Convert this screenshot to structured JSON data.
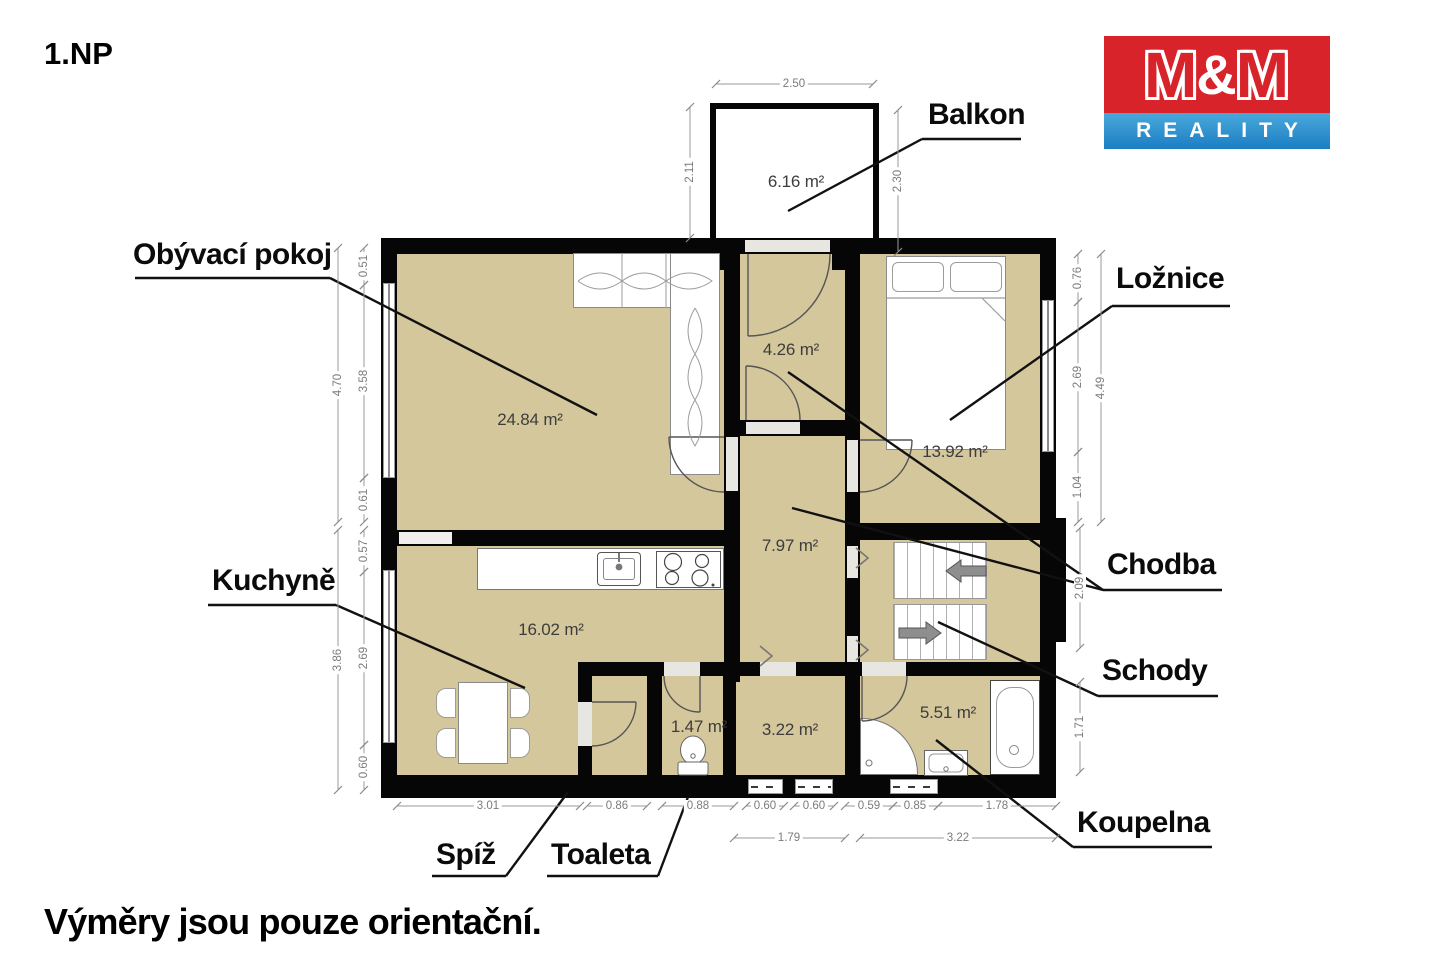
{
  "page": {
    "floor_label": "1.NP",
    "footer_note": "Výměry jsou pouze orientační."
  },
  "logo": {
    "m1": "M",
    "amp": "&",
    "m2": "M",
    "subtitle": "REALITY",
    "red": "#d8232a",
    "blue": "#2b8fce"
  },
  "colors": {
    "floor_fill": "#d5c79c",
    "wall": "#060606",
    "dimension": "#7b7b7b"
  },
  "room_labels": [
    {
      "id": "obyvaci-pokoj",
      "text": "Obývací pokoj",
      "x": 133,
      "y": 238,
      "underline": [
        135,
        278,
        330,
        278
      ],
      "leaders": [
        [
          330,
          278,
          597,
          415
        ]
      ]
    },
    {
      "id": "balkon",
      "text": "Balkon",
      "x": 928,
      "y": 98,
      "underline": [
        922,
        139,
        1021,
        139
      ],
      "leaders": [
        [
          922,
          139,
          788,
          211
        ]
      ]
    },
    {
      "id": "loznice",
      "text": "Ložnice",
      "x": 1116,
      "y": 262,
      "underline": [
        1112,
        306,
        1230,
        306
      ],
      "leaders": [
        [
          1112,
          306,
          950,
          420
        ]
      ]
    },
    {
      "id": "chodba",
      "text": "Chodba",
      "x": 1107,
      "y": 548,
      "underline": [
        1103,
        590,
        1222,
        590
      ],
      "leaders": [
        [
          1103,
          590,
          792,
          508
        ],
        [
          1103,
          590,
          788,
          372
        ]
      ]
    },
    {
      "id": "schody",
      "text": "Schody",
      "x": 1102,
      "y": 654,
      "underline": [
        1098,
        696,
        1218,
        696
      ],
      "leaders": [
        [
          1098,
          696,
          938,
          622
        ]
      ]
    },
    {
      "id": "kuchyne",
      "text": "Kuchyně",
      "x": 212,
      "y": 564,
      "underline": [
        208,
        605,
        336,
        605
      ],
      "leaders": [
        [
          336,
          605,
          525,
          688
        ]
      ]
    },
    {
      "id": "spiz",
      "text": "Spíž",
      "x": 436,
      "y": 838,
      "underline": [
        432,
        876,
        506,
        876
      ],
      "leaders": [
        [
          506,
          876,
          568,
          792
        ]
      ]
    },
    {
      "id": "toaleta",
      "text": "Toaleta",
      "x": 551,
      "y": 838,
      "underline": [
        547,
        876,
        658,
        876
      ],
      "leaders": [
        [
          658,
          876,
          688,
          797
        ]
      ]
    },
    {
      "id": "koupelna",
      "text": "Koupelna",
      "x": 1077,
      "y": 806,
      "underline": [
        1073,
        847,
        1212,
        847
      ],
      "leaders": [
        [
          1073,
          847,
          936,
          740
        ]
      ]
    }
  ],
  "area_labels": [
    {
      "id": "balkon",
      "text": "6.16 m²",
      "x": 796,
      "y": 182
    },
    {
      "id": "obyvaci-pokoj",
      "text": "24.84 m²",
      "x": 530,
      "y": 420
    },
    {
      "id": "loznice",
      "text": "13.92 m²",
      "x": 955,
      "y": 452
    },
    {
      "id": "vestibul",
      "text": "4.26 m²",
      "x": 791,
      "y": 350
    },
    {
      "id": "chodba",
      "text": "7.97 m²",
      "x": 790,
      "y": 546
    },
    {
      "id": "kuchyne",
      "text": "16.02 m²",
      "x": 551,
      "y": 630
    },
    {
      "id": "toaleta",
      "text": "1.47 m²",
      "x": 699,
      "y": 727
    },
    {
      "id": "predsin",
      "text": "3.22 m²",
      "x": 790,
      "y": 730
    },
    {
      "id": "koupelna",
      "text": "5.51 m²",
      "x": 948,
      "y": 713
    }
  ],
  "dimensions": [
    {
      "label": "2.50",
      "x": 794,
      "y": 84,
      "v": false,
      "line": [
        716,
        84,
        873,
        84
      ]
    },
    {
      "label": "2.11",
      "x": 690,
      "y": 172,
      "v": true,
      "line": [
        690,
        107,
        690,
        238
      ]
    },
    {
      "label": "2.30",
      "x": 898,
      "y": 181,
      "v": true,
      "line": [
        898,
        110,
        898,
        252
      ]
    },
    {
      "label": "4.70",
      "x": 338,
      "y": 385,
      "v": true,
      "line": [
        338,
        248,
        338,
        522
      ]
    },
    {
      "label": "0.51",
      "x": 364,
      "y": 266,
      "v": true,
      "line": [
        364,
        248,
        364,
        285
      ]
    },
    {
      "label": "3.58",
      "x": 364,
      "y": 381,
      "v": true,
      "line": [
        364,
        285,
        364,
        478
      ]
    },
    {
      "label": "0.61",
      "x": 364,
      "y": 500,
      "v": true,
      "line": [
        364,
        478,
        364,
        522
      ]
    },
    {
      "label": "3.86",
      "x": 338,
      "y": 660,
      "v": true,
      "line": [
        338,
        530,
        338,
        790
      ]
    },
    {
      "label": "0.57",
      "x": 364,
      "y": 551,
      "v": true,
      "line": [
        364,
        530,
        364,
        572
      ]
    },
    {
      "label": "2.69",
      "x": 364,
      "y": 658,
      "v": true,
      "line": [
        364,
        572,
        364,
        745
      ]
    },
    {
      "label": "0.60",
      "x": 364,
      "y": 767,
      "v": true,
      "line": [
        364,
        745,
        364,
        790
      ]
    },
    {
      "label": "0.76",
      "x": 1078,
      "y": 278,
      "v": true,
      "line": [
        1078,
        254,
        1078,
        302
      ]
    },
    {
      "label": "2.69",
      "x": 1078,
      "y": 377,
      "v": true,
      "line": [
        1078,
        302,
        1078,
        452
      ]
    },
    {
      "label": "1.04",
      "x": 1078,
      "y": 487,
      "v": true,
      "line": [
        1078,
        452,
        1078,
        522
      ]
    },
    {
      "label": "4.49",
      "x": 1101,
      "y": 388,
      "v": true,
      "line": [
        1101,
        254,
        1101,
        522
      ]
    },
    {
      "label": "2.09",
      "x": 1080,
      "y": 588,
      "v": true,
      "line": [
        1080,
        528,
        1080,
        648
      ]
    },
    {
      "label": "1.71",
      "x": 1080,
      "y": 727,
      "v": true,
      "line": [
        1080,
        682,
        1080,
        772
      ]
    },
    {
      "label": "3.01",
      "x": 488,
      "y": 806,
      "v": false,
      "line": [
        397,
        806,
        580,
        806
      ]
    },
    {
      "label": "0.86",
      "x": 617,
      "y": 806,
      "v": false,
      "line": [
        587,
        806,
        647,
        806
      ]
    },
    {
      "label": "0.88",
      "x": 698,
      "y": 806,
      "v": false,
      "line": [
        662,
        806,
        734,
        806
      ]
    },
    {
      "label": "0.60",
      "x": 765,
      "y": 806,
      "v": false,
      "line": [
        746,
        806,
        784,
        806
      ]
    },
    {
      "label": "0.60",
      "x": 814,
      "y": 806,
      "v": false,
      "line": [
        794,
        806,
        834,
        806
      ]
    },
    {
      "label": "0.59",
      "x": 869,
      "y": 806,
      "v": false,
      "line": [
        845,
        806,
        893,
        806
      ]
    },
    {
      "label": "0.85",
      "x": 915,
      "y": 806,
      "v": false,
      "line": [
        893,
        806,
        938,
        806
      ]
    },
    {
      "label": "1.78",
      "x": 997,
      "y": 806,
      "v": false,
      "line": [
        938,
        806,
        1056,
        806
      ]
    },
    {
      "label": "1.79",
      "x": 789,
      "y": 838,
      "v": false,
      "line": [
        734,
        838,
        845,
        838
      ]
    },
    {
      "label": "3.22",
      "x": 958,
      "y": 838,
      "v": false,
      "line": [
        860,
        838,
        1056,
        838
      ]
    }
  ]
}
